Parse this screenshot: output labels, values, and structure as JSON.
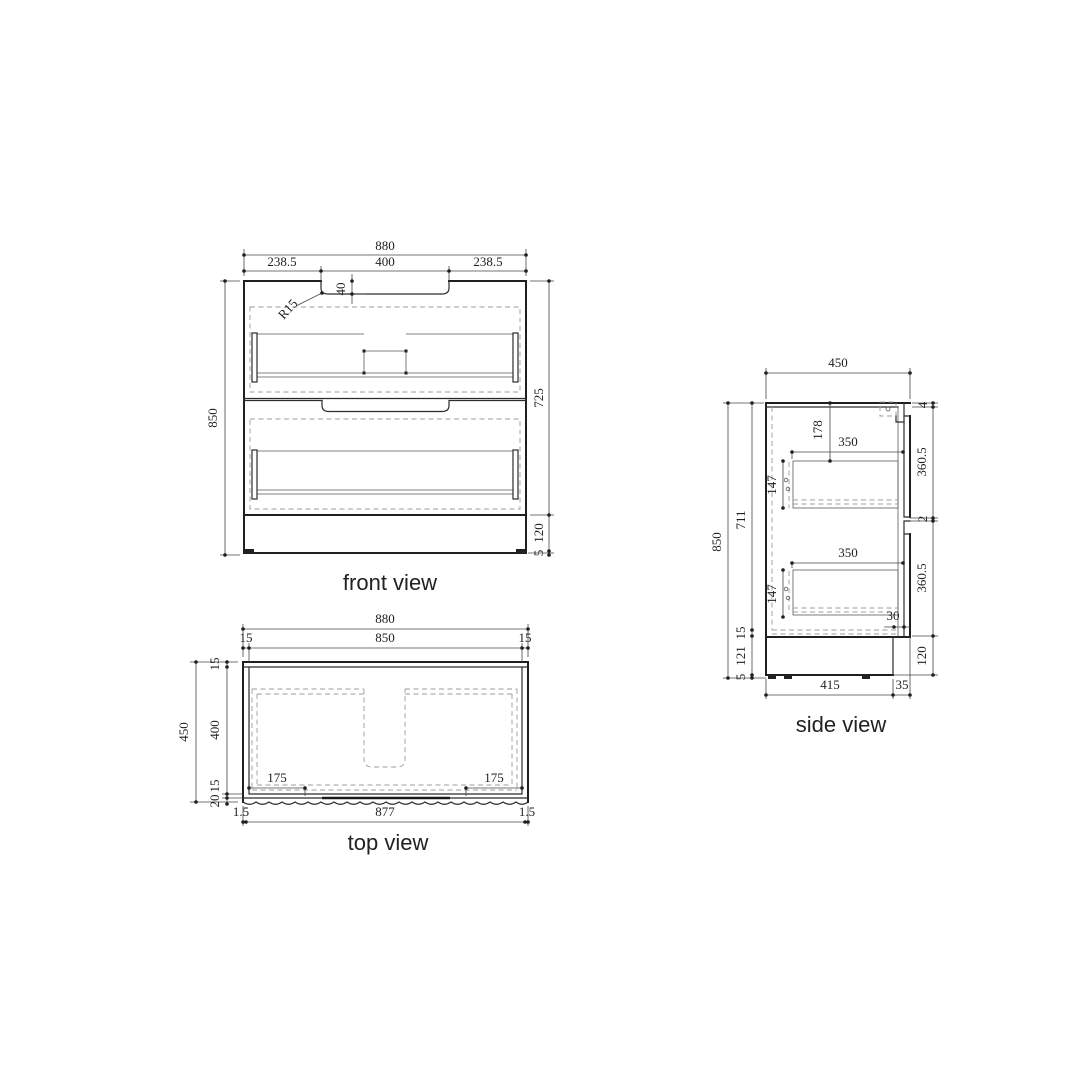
{
  "front": {
    "label": "front view",
    "overall_width": "880",
    "left_offset": "238.5",
    "recess_width": "400",
    "right_offset": "238.5",
    "recess_depth": "40",
    "radius": "R15",
    "overall_height": "850",
    "body_height": "725",
    "plinth_height": "120",
    "foot_height": "5"
  },
  "top": {
    "label": "top view",
    "overall_width": "880",
    "inner_width": "850",
    "wall_left": "15",
    "wall_right": "15",
    "overall_depth": "450",
    "back_wall": "15",
    "inner_depth": "400",
    "front_panel": "15",
    "groove_depth": "20",
    "recess_offset_left": "175",
    "recess_offset_right": "175",
    "edge_left": "1.5",
    "front_width": "877",
    "edge_right": "1.5"
  },
  "side": {
    "label": "side view",
    "overall_depth": "450",
    "top_thickness": "4",
    "upper_front_height": "360.5",
    "gap": "2",
    "lower_front_height": "360.5",
    "plinth_height": "120",
    "overall_height": "850",
    "interior_height": "711",
    "bottom_thickness": "15",
    "plinth_inner": "121",
    "foot_height": "5",
    "top_to_drawer": "178",
    "upper_drawer_depth": "350",
    "upper_drawer_height": "147",
    "lower_drawer_depth": "350",
    "lower_drawer_height": "147",
    "front_overhang": "30",
    "plinth_depth": "415",
    "front_offset": "35"
  }
}
